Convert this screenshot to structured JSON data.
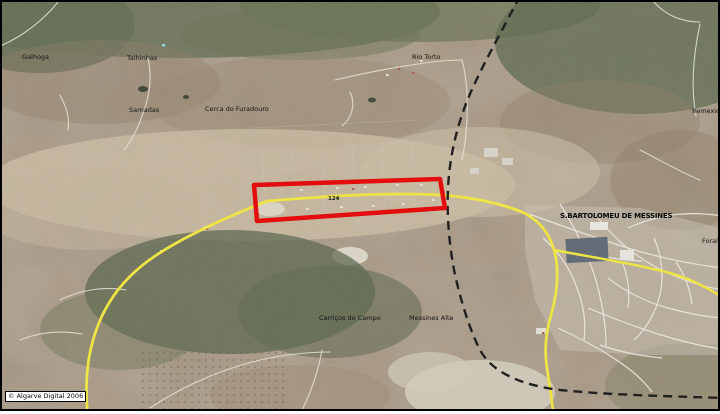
{
  "map": {
    "credit": "© Algarve Digital 2006",
    "road_number": "124",
    "labels": {
      "galhoga": "Galhoga",
      "talhinhas": "Talhinhas",
      "sarnadas": "Sarnadas",
      "cerca": "Cerca do Furadouro",
      "rio_torto": "Rio Torto",
      "town": "S.BARTOLOMEU DE MESSINES",
      "carricos": "Carriços do Campo",
      "messines_alte": "Messines Alte",
      "remexido": "Remexido",
      "foral": "Foral"
    },
    "colors": {
      "highlight-red": "#e60000",
      "road-yellow": "#f2e73b",
      "railway-black": "#141414",
      "terrain-tan": "#a89781",
      "woodland-green": "#5d684d"
    }
  }
}
